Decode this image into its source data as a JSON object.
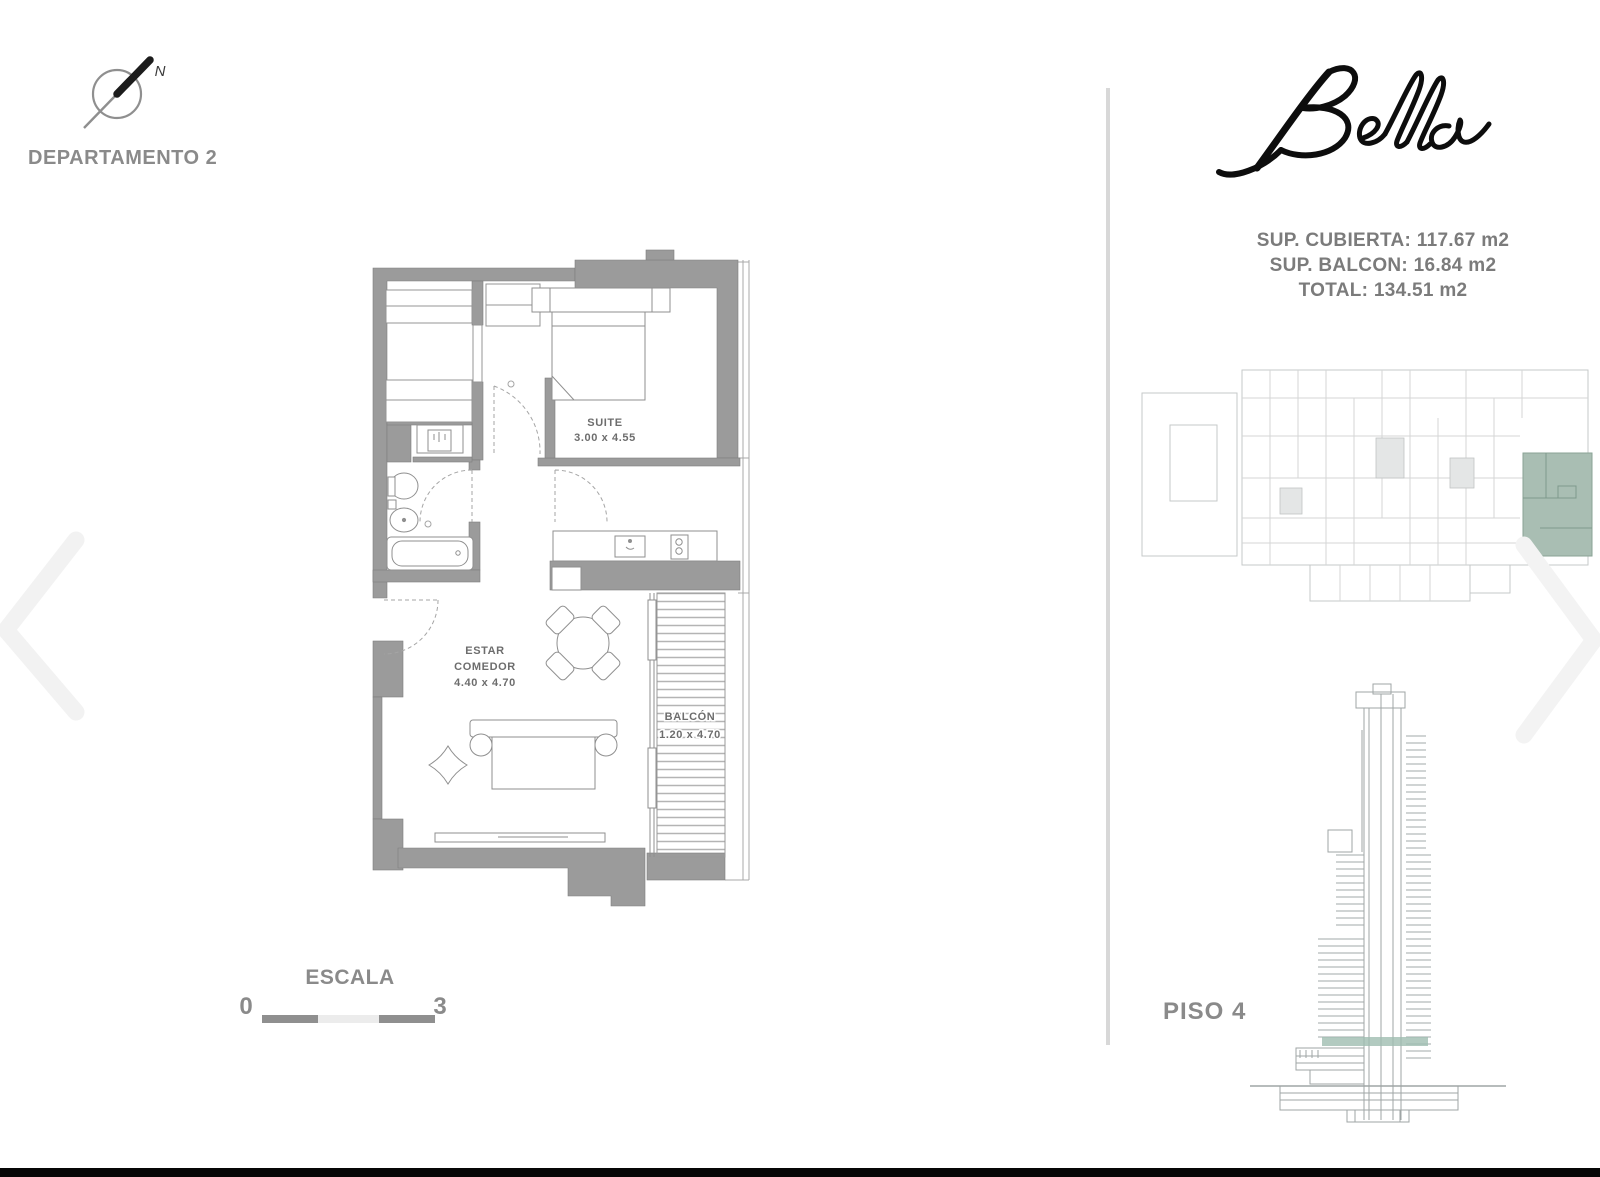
{
  "title": {
    "unit": "DEPARTAMENTO 2"
  },
  "north": {
    "label": "N"
  },
  "rooms": {
    "suite": {
      "name": "SUITE",
      "dims": "3.00 x 4.55"
    },
    "living": {
      "name_line1": "ESTAR",
      "name_line2": "COMEDOR",
      "dims": "4.40 x 4.70"
    },
    "balcony": {
      "name": "BALCÓN",
      "dims": "1.20 x 4.70"
    }
  },
  "scalebar": {
    "label": "ESCALA",
    "min": "0",
    "max": "3"
  },
  "brand": {
    "name": "Bella"
  },
  "areas": {
    "covered": "SUP. CUBIERTA: 117.67 m2",
    "balcony": "SUP. BALCON: 16.84 m2",
    "total": "TOTAL: 134.51 m2"
  },
  "floor": {
    "label": "PISO 4"
  },
  "icons": {
    "north": "north-arrow",
    "prev": "chevron-left",
    "next": "chevron-right"
  },
  "colors": {
    "highlight_unit": "#a9beb3",
    "floor_band": "#9fbdb0",
    "wall_gray": "#9b9b9b"
  }
}
